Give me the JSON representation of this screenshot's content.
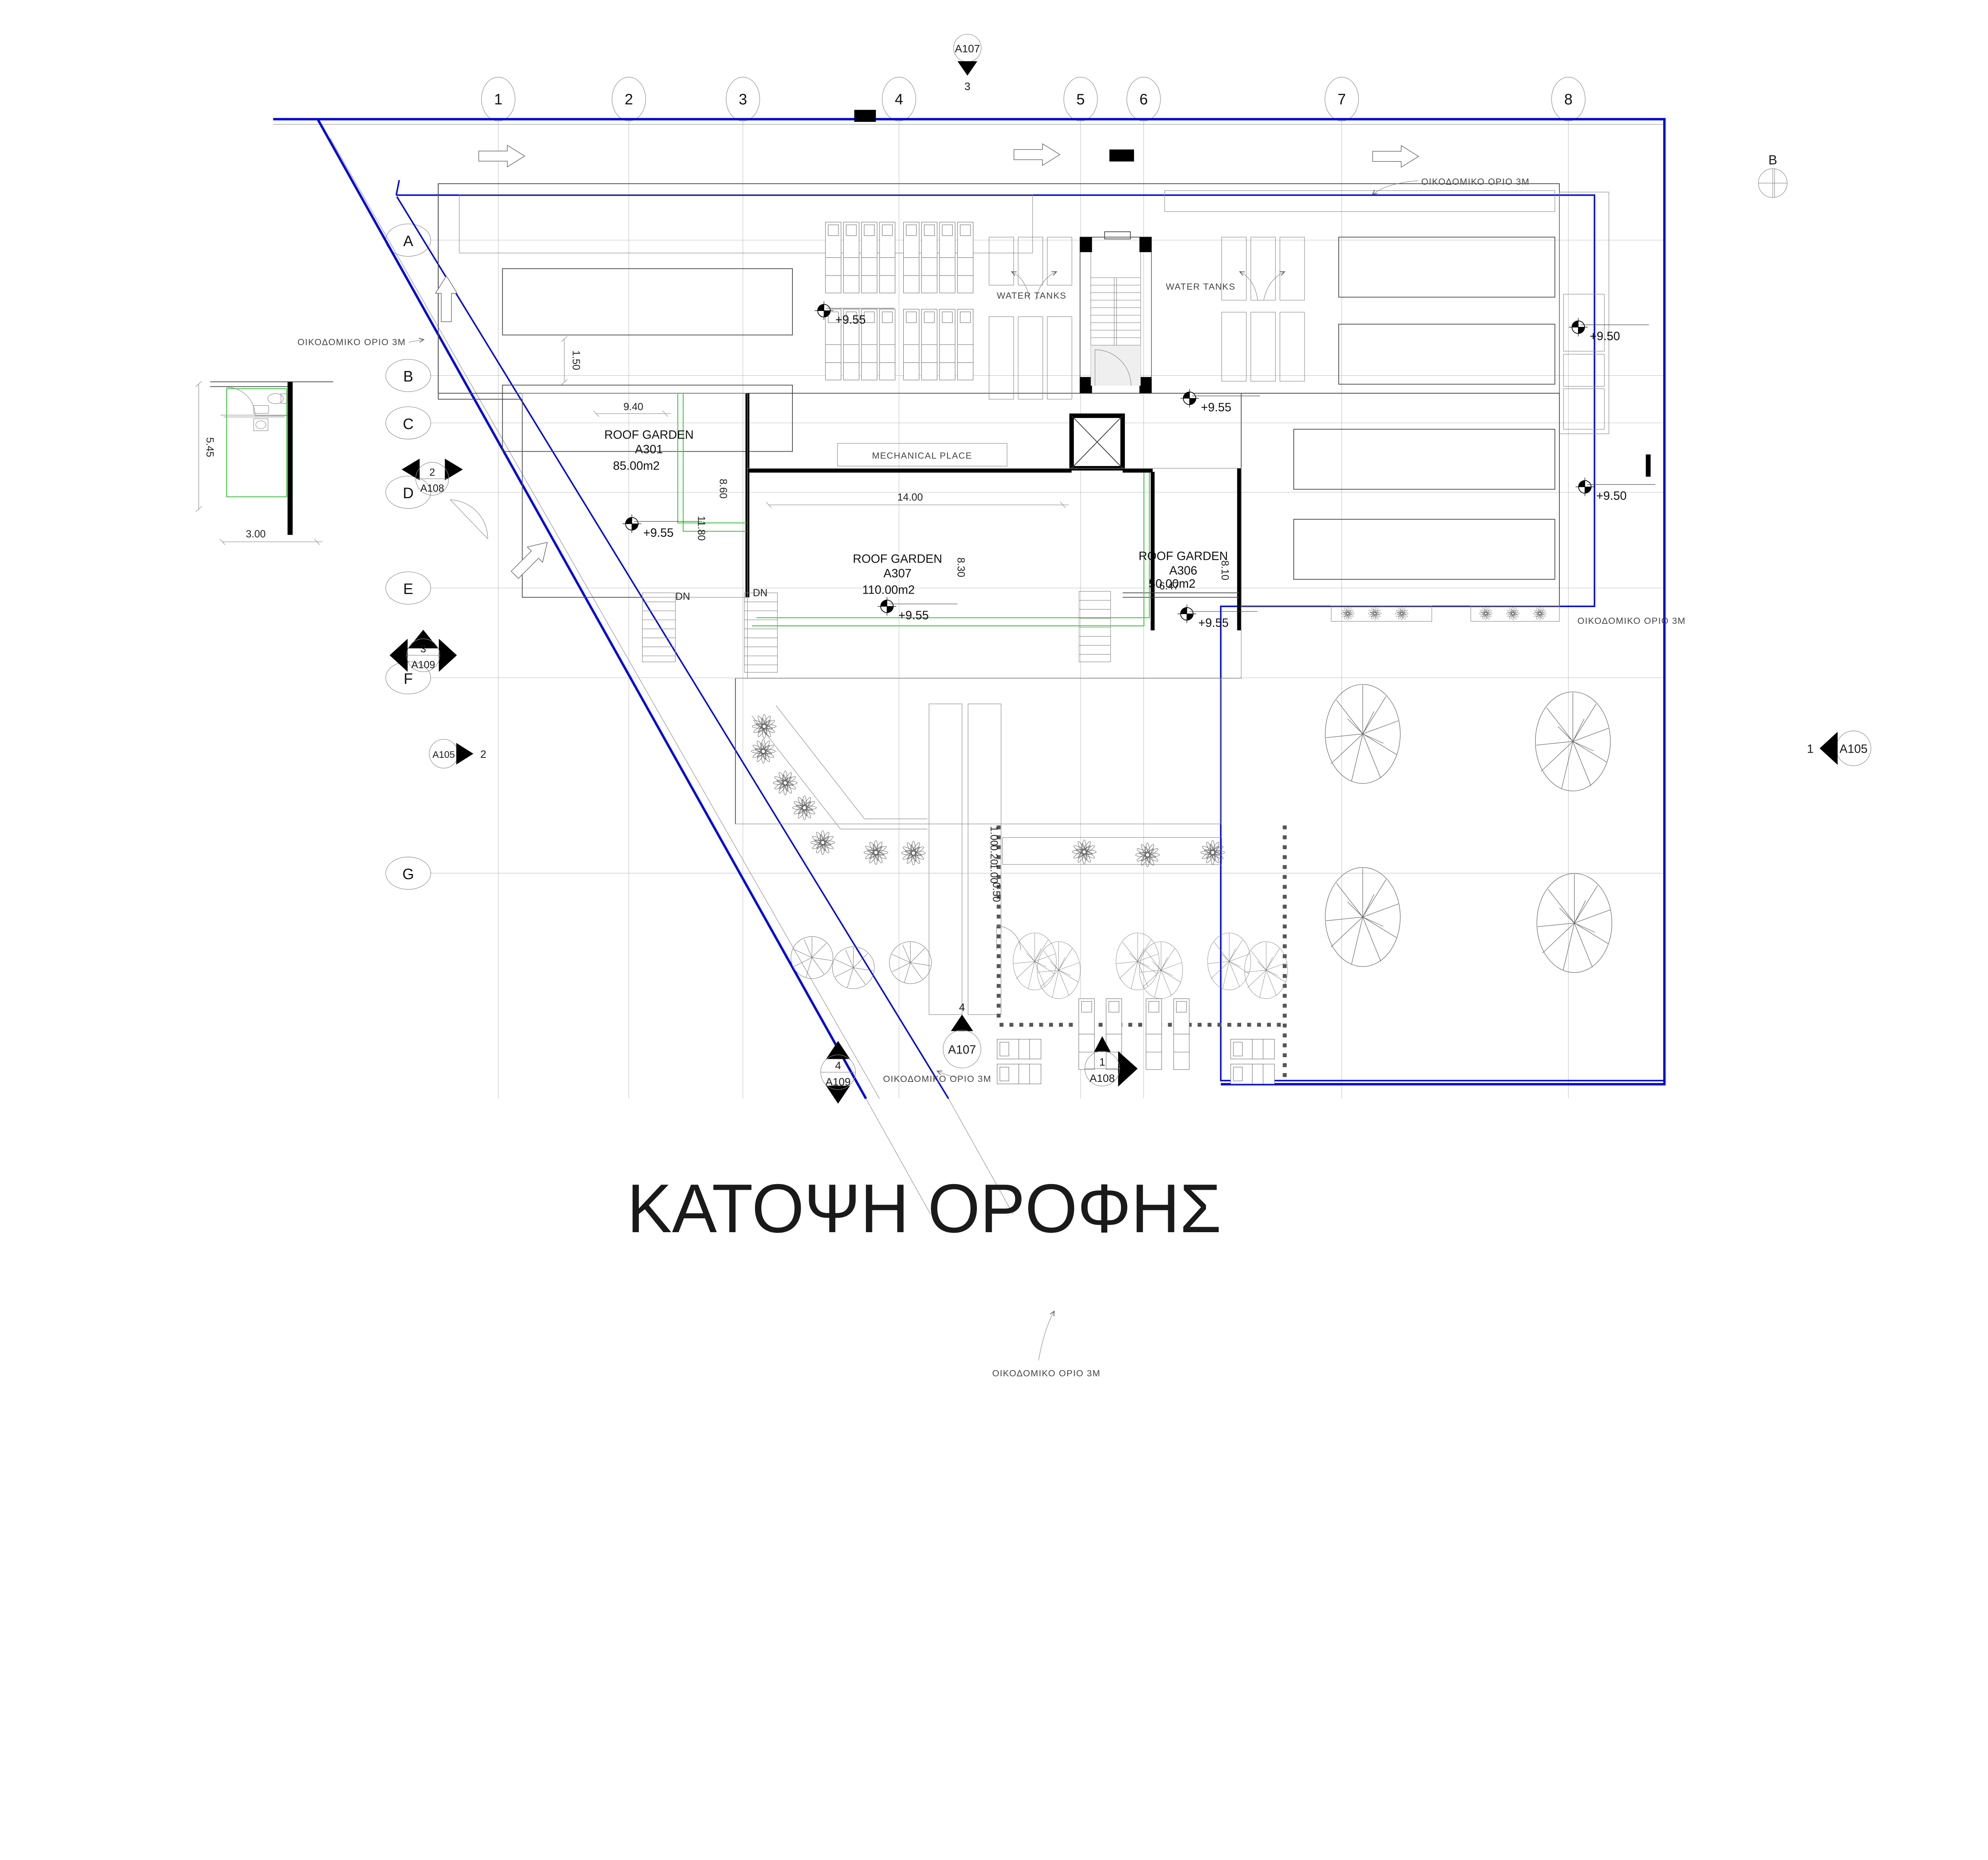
{
  "title": "ΚΑΤΟΨΗ ΟΡΟΦΗΣ",
  "north_label": "B",
  "grid": {
    "cols": [
      "1",
      "2",
      "3",
      "4",
      "5",
      "6",
      "7",
      "8"
    ],
    "rows": [
      "A",
      "B",
      "C",
      "D",
      "E",
      "F",
      "G"
    ]
  },
  "rooms": {
    "rg1": {
      "name": "ROOF GARDEN",
      "code": "A301",
      "area": "85.00m2"
    },
    "rg2": {
      "name": "ROOF GARDEN",
      "code": "A307",
      "area": "110.00m2"
    },
    "rg3": {
      "name": "ROOF GARDEN",
      "code": "A306",
      "area": "50.00m2"
    },
    "mechanical": "MECHANICAL PLACE",
    "water_tanks": "WATER TANKS"
  },
  "levels": {
    "main": "+9.55",
    "right": "+9.50"
  },
  "dims": {
    "d940": "9.40",
    "d860": "8.60",
    "d1180": "11.80",
    "d1400": "14.00",
    "d830": "8.30",
    "d810": "8.10",
    "d647": "6.47",
    "d545": "5.45",
    "d300": "3.00",
    "d150": "1.50",
    "d100a": "1.00",
    "d020": "0.20",
    "d100b": "1.00",
    "d050": "0.50"
  },
  "stairs": {
    "dn": "DN"
  },
  "notes": {
    "building_limit": "ΟΙΚΟΔΟΜΙΚΟ ΟΡΙΟ 3Μ"
  },
  "markers": {
    "a107_top": {
      "code": "A107",
      "num": "3"
    },
    "a107_bottom": {
      "code": "A107",
      "num": "4"
    },
    "a108_left": {
      "code": "A108",
      "num": "2"
    },
    "a108_bottom": {
      "code": "A108",
      "num": "1"
    },
    "a109_left": {
      "code": "A109",
      "num": "3"
    },
    "a109_bottom": {
      "code": "A109",
      "num": "4"
    },
    "a105_left": {
      "code": "A105",
      "num": "2"
    },
    "a105_right": {
      "code": "A105",
      "num": "1"
    }
  }
}
